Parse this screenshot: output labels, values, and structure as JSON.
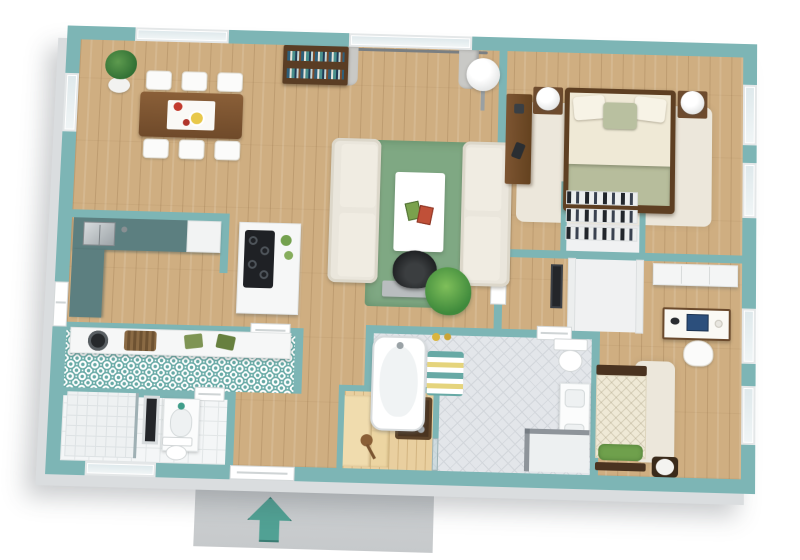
{
  "meta": {
    "view": "3d-top-down-floor-plan",
    "style": "rendered isometric house plan, no text labels visible",
    "entrance_arrow_direction": "up"
  },
  "palette": {
    "wall_teal": "#7db5b5",
    "wall_white": "#eceeee",
    "floor_wood": "#cfae81",
    "rug_green": "#7fa883",
    "rug_cream": "#ece7db",
    "sofa_cream": "#eae6dc",
    "dark_wood": "#6f4c2e",
    "pattern_teal": "#67a9a5",
    "sauna_wood": "#e9cf9f",
    "bedding_cream": "#efe9d6",
    "bedding_sage": "#b7bd9c",
    "counter_teal_grey": "#5c7f80",
    "entry_pad_grey": "#caccce",
    "arrow_teal": "#58ab9e",
    "glass_blue": "#dfe9ec",
    "appliance_black": "#1f2125"
  },
  "rooms": [
    {
      "name": "Dining Area",
      "floor": "wood",
      "furniture": [
        "potted plant",
        "dining table",
        "white table runner",
        "flower vase",
        "fruit plate",
        "6 white chairs"
      ]
    },
    {
      "name": "Living Room",
      "floor": "wood",
      "furniture": [
        "bookshelf with books",
        "two cream sofas facing",
        "green area rug",
        "white coffee table",
        "magazines",
        "floor lamp",
        "curtained window"
      ]
    },
    {
      "name": "Master Bedroom",
      "floor": "wood",
      "furniture": [
        "double bed with sage blanket",
        "two nightstands",
        "two white table lamps",
        "cream area rug",
        "dark wood desk"
      ]
    },
    {
      "name": "Kitchen",
      "floor": "wood",
      "furniture": [
        "L-shaped counter with steel sink",
        "white corner cabinet",
        "island with black cooktop"
      ]
    },
    {
      "name": "Laundry Room",
      "floor": "patterned teal tile",
      "furniture": [
        "white counter",
        "wicker basket",
        "green towels",
        "washing machine"
      ]
    },
    {
      "name": "Small Bathroom",
      "floor": "white tile",
      "furniture": [
        "shower with glass panel",
        "framed mirror",
        "vanity sink",
        "toilet"
      ]
    },
    {
      "name": "Hallway",
      "floor": "wood",
      "furniture": [
        "black armchair",
        "grey console",
        "potted plant"
      ]
    },
    {
      "name": "Sauna",
      "floor": "light sauna wood",
      "furniture": [
        "wood benches",
        "sauna heater with stones",
        "wooden ladle",
        "glass door"
      ]
    },
    {
      "name": "Main Bathroom",
      "floor": "grey herringbone tile",
      "furniture": [
        "bathtub",
        "striped bath mat",
        "toilet",
        "double vanity",
        "glass shower"
      ]
    },
    {
      "name": "Shoe Closet",
      "floor": "white",
      "furniture": [
        "shoe shelves"
      ]
    },
    {
      "name": "Walk-in Closet",
      "floor": "white",
      "furniture": []
    },
    {
      "name": "Vestibule",
      "floor": "wood",
      "furniture": [
        "dark picture frame"
      ]
    },
    {
      "name": "Bedroom 2",
      "floor": "wood",
      "furniture": [
        "white wardrobe",
        "desk with computer",
        "white office chair",
        "single bed with green pillow",
        "cream rug",
        "round stool"
      ]
    },
    {
      "name": "Entrance",
      "floor": "concrete pad",
      "furniture": [
        "teal direction arrow pointing into house"
      ]
    }
  ]
}
